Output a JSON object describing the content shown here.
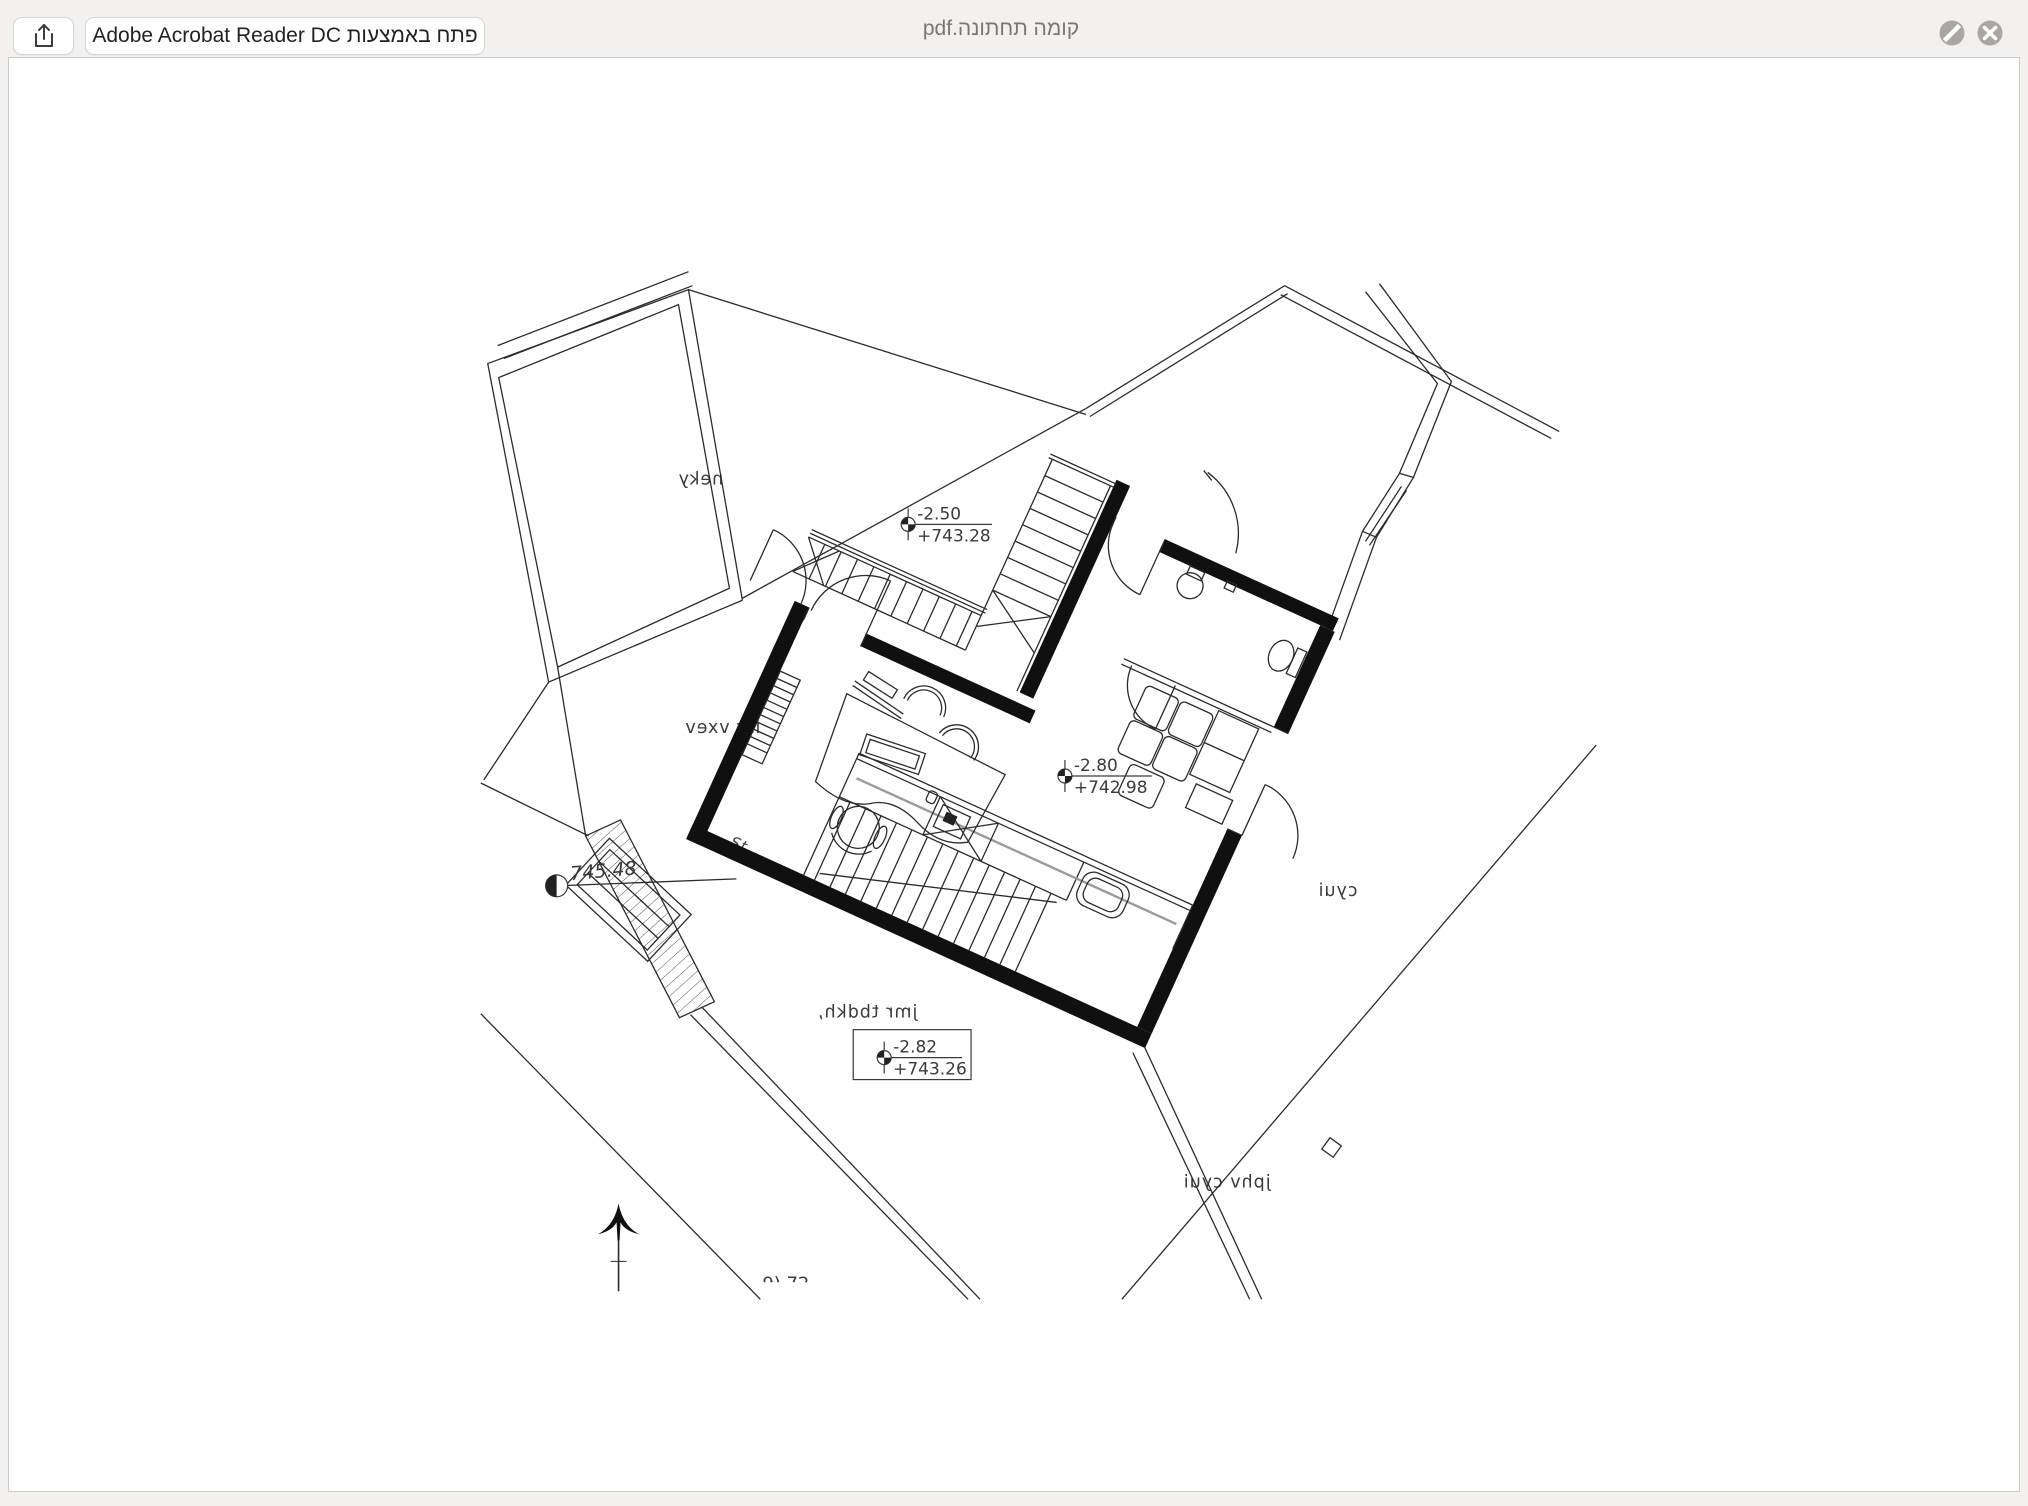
{
  "window": {
    "titlebar": {
      "filename": "קומה תחתונה.pdf",
      "open_with_button": "פתח באמצעות Adobe Acrobat Reader DC",
      "share_icon": "share-up-arrow",
      "slash_icon": "slash-circle",
      "close_icon": "x-circle"
    }
  },
  "plan": {
    "mirrored_text": true,
    "levels": [
      {
        "relative": "-2.50",
        "absolute": "+743.28"
      },
      {
        "relative": "-2.80",
        "absolute": "+742.98"
      },
      {
        "relative": "-2.82",
        "absolute": "+743.26"
      }
    ],
    "spot_elevation": "745.48",
    "room_labels": {
      "top_room": "neky",
      "study": "isr vxev",
      "family_room": "jmr tbdkh,",
      "road": "cyui",
      "road_path": "jphv cyui"
    },
    "small_text": "St",
    "partial_bottom_text": "9) 72",
    "colors": {
      "walls": "#101010",
      "thin_lines": "#2b2b2b",
      "accent_gray": "#9b9b9b",
      "annotation": "#3a3a3a"
    }
  }
}
